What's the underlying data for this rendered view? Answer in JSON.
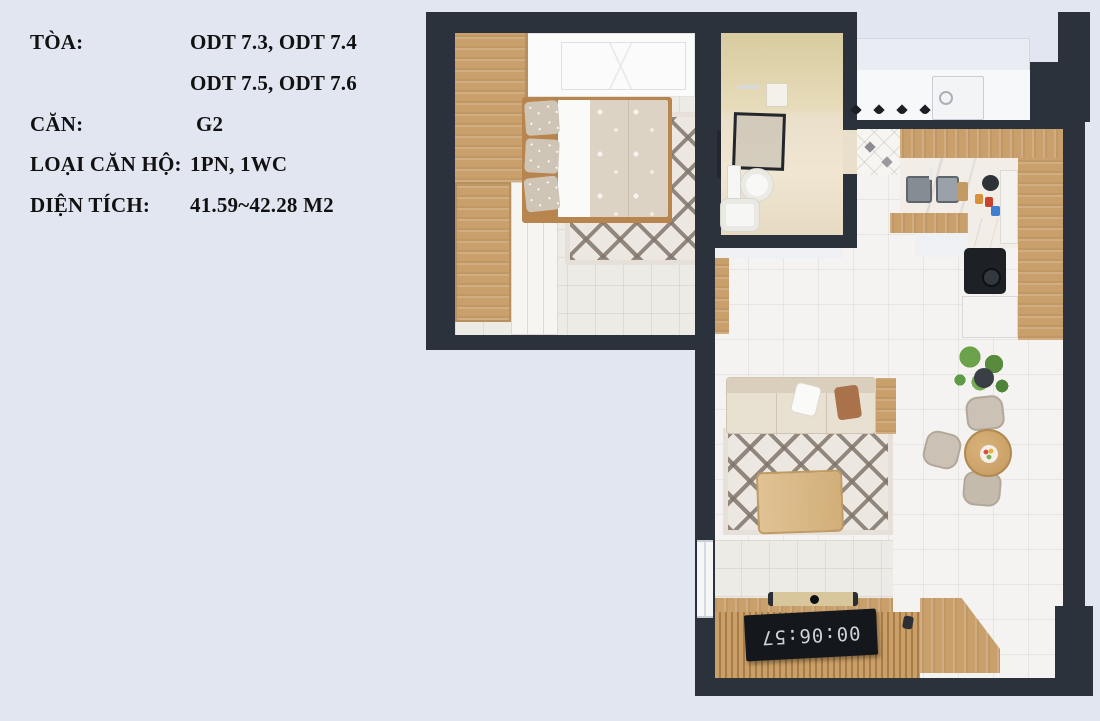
{
  "info_panel": {
    "rows": [
      {
        "label": "TÒA:",
        "value": "ODT 7.3, ODT 7.4"
      },
      {
        "label": "",
        "value": "ODT 7.5, ODT 7.6"
      },
      {
        "label": "CĂN:",
        "value": "G2"
      },
      {
        "label": "LOẠI CĂN HỘ:",
        "value": "1PN, 1WC"
      },
      {
        "label": "DIỆN TÍCH:",
        "value": "41.59~42.28 M2"
      }
    ]
  },
  "floor_plan": {
    "tv_clock": "00:06:57",
    "rooms": [
      "bedroom",
      "bathroom",
      "entry-hall",
      "kitchen",
      "dining-area",
      "living-room",
      "tv-wall"
    ],
    "furniture": [
      "wardrobe",
      "double-bed",
      "bedroom-rug",
      "shower",
      "toilet",
      "bathroom-sink",
      "washing-machine",
      "wall-hooks",
      "kitchen-counter",
      "kitchen-sink",
      "cooktop",
      "sofa",
      "living-rug",
      "coffee-table",
      "dining-table",
      "dining-chairs",
      "plant",
      "tv-screen",
      "soundbar"
    ]
  },
  "colors": {
    "bg": "#e2e6f1",
    "wall": "#2b323c",
    "wood": "#c9a06c",
    "wood-dark": "#b08050",
    "tile": "#f4f3f1",
    "rug-base": "#ece7e0",
    "rug-pat": "#8f8379",
    "sofa": "#e8e0d0",
    "bath-wall": "#ddd0a6",
    "bath-floor": "#eadfca",
    "plant": "#68a14a",
    "ink": "#111111"
  }
}
